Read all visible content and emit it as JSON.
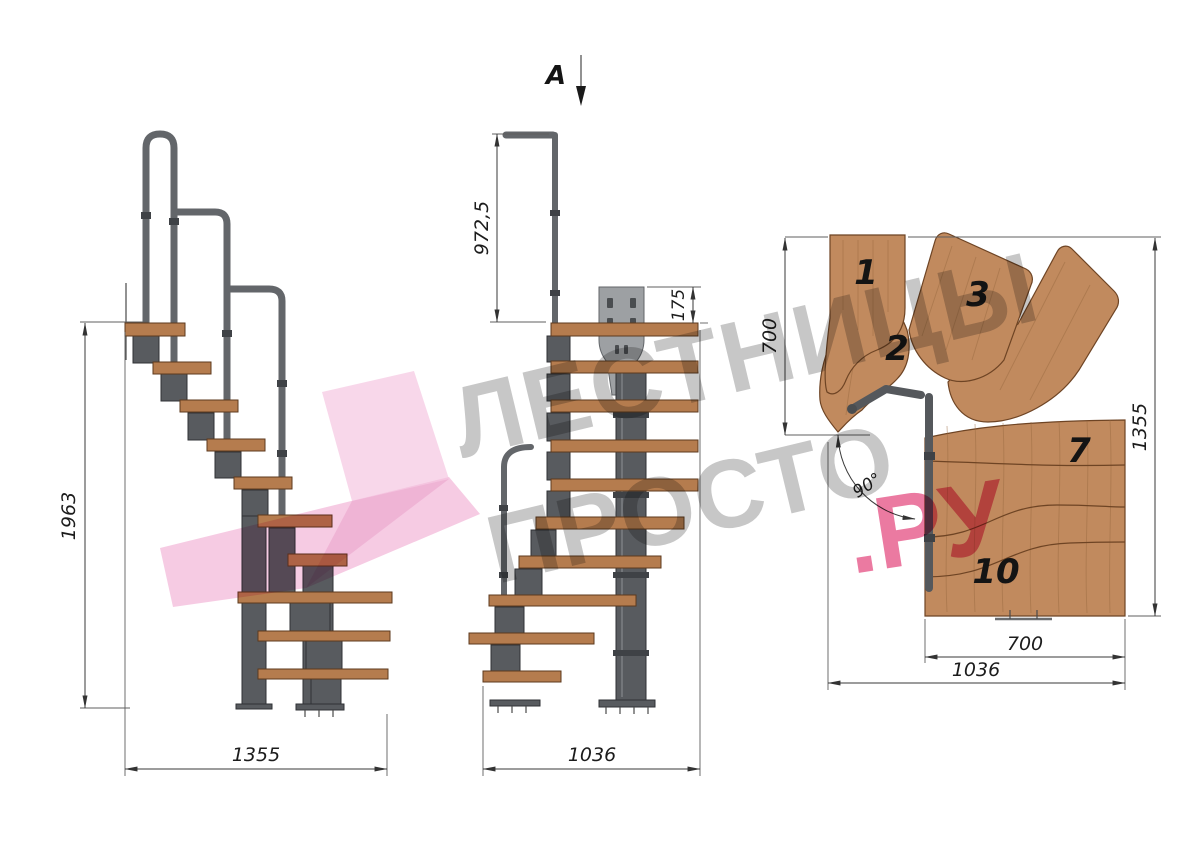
{
  "views": {
    "side": {
      "dims": {
        "height": "1963",
        "length": "1355"
      }
    },
    "front": {
      "section_label": "A",
      "dims": {
        "rail_height": "972,5",
        "bracket_offset": "175",
        "width": "1036"
      }
    },
    "plan": {
      "dims": {
        "inner_width": "700",
        "depth": "1355",
        "flight_width": "700",
        "total_width": "1036",
        "turn_angle": "90°"
      },
      "tread_numbers": [
        "1",
        "2",
        "3",
        "7",
        "10"
      ]
    }
  },
  "watermark": {
    "line1": "ЛЕСТНИЦЫ",
    "line2": "ПРОСТО",
    "accent": ".РУ"
  },
  "colors": {
    "wood": "#c18a5e",
    "wood_edge": "#6e4424",
    "steel": "#585b5f",
    "rail": "#63666a",
    "dim_line": "#3a3a3a",
    "watermark_gray": "#8f8f8f",
    "watermark_pink": "#f4c2de",
    "accent_red": "#e0336f"
  }
}
